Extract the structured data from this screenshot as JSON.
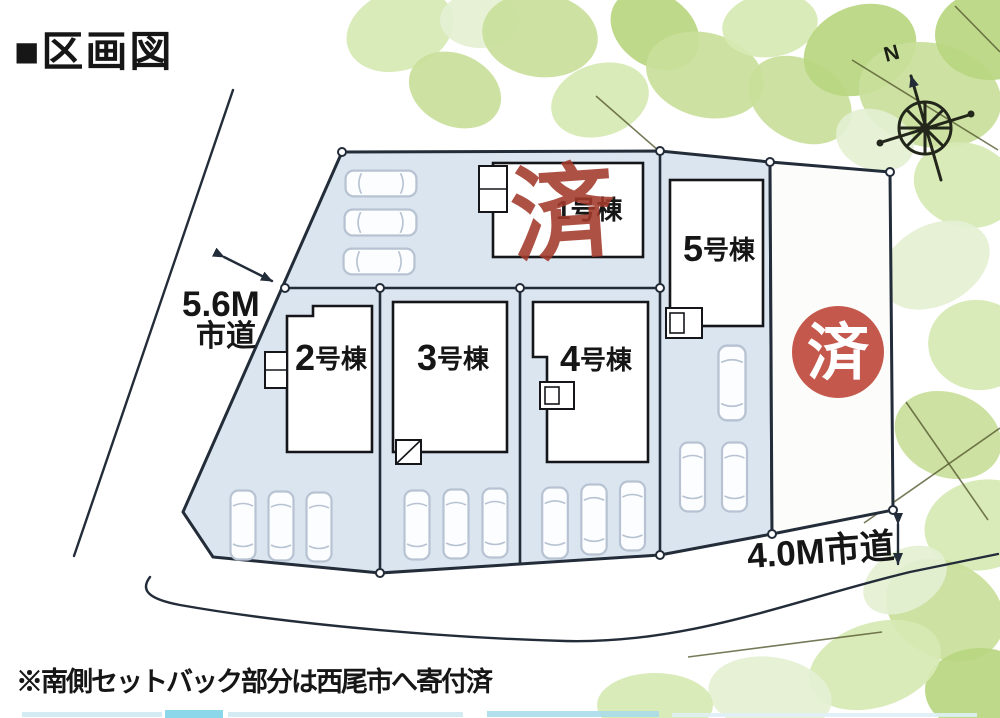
{
  "page": {
    "title": "■区画図",
    "footnote": "※南側セットバック部分は西尾市へ寄付済"
  },
  "roads": {
    "west": {
      "width": "5.6M",
      "type": "市道"
    },
    "south": {
      "label": "4.0M市道"
    }
  },
  "compass": {
    "north": "N"
  },
  "buildings": [
    {
      "number": "1",
      "suffix": "号棟",
      "label": "1号棟",
      "status": "sold",
      "stamp": "済"
    },
    {
      "number": "2",
      "suffix": "号棟",
      "label": "2号棟",
      "status": "available"
    },
    {
      "number": "3",
      "suffix": "号棟",
      "label": "3号棟",
      "status": "available"
    },
    {
      "number": "4",
      "suffix": "号棟",
      "label": "4号棟",
      "status": "available"
    },
    {
      "number": "5",
      "suffix": "号棟",
      "label": "5号棟",
      "status": "available"
    }
  ],
  "right_lot": {
    "status": "sold",
    "stamp": "済"
  },
  "colors": {
    "line": "#232c39",
    "plot_fill": "#dbe5ef",
    "car_line": "#b7c3d2",
    "stamp_red": "#a23a2c",
    "stamp_circle": "#c04a3e",
    "leaf_1": "#e4f0d2",
    "leaf_2": "#d7e9b4",
    "leaf_3": "#c9e09a",
    "leaf_4": "#b8d680",
    "strip_blue": "#9fdbea"
  }
}
